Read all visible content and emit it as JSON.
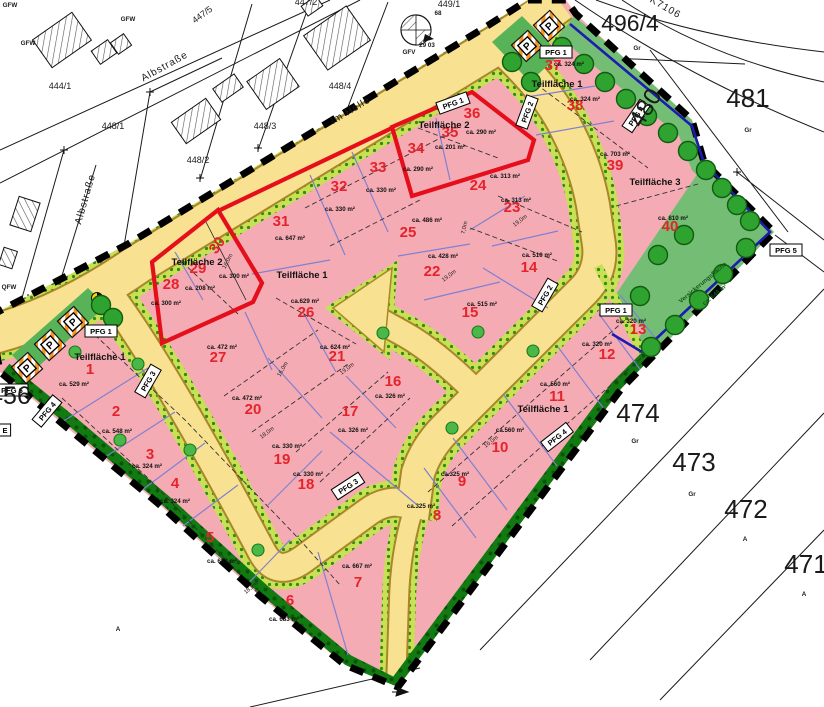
{
  "map": {
    "colors": {
      "plot_pink": "#f5abb4",
      "road_yellow": "#f8e190",
      "road_edge": "#a8872a",
      "veg_strip": "#c8e052",
      "veg_dot": "#2f8b1f",
      "tree_green": "#2fa32f",
      "zone_green": "#74bd74",
      "dark_strip": "#117a11",
      "boundary_black": "#000000",
      "red_outline": "#e50e1b",
      "blue_line": "#1c1cb0",
      "parcel_blue": "#8080d0",
      "plot_number_red": "#e5232b"
    },
    "plots": [
      {
        "no": "1",
        "num_xy": [
          90,
          374
        ],
        "area": "ca. 529 m²",
        "area_xy": [
          74,
          386
        ]
      },
      {
        "no": "2",
        "num_xy": [
          116,
          416
        ],
        "area": "ca. 548 m²",
        "area_xy": [
          117,
          433
        ]
      },
      {
        "no": "3",
        "num_xy": [
          150,
          459
        ],
        "area": "ca. 324 m²",
        "area_xy": [
          147,
          468
        ]
      },
      {
        "no": "4",
        "num_xy": [
          175,
          488
        ],
        "area": "ca. 324 m²",
        "area_xy": [
          175,
          503
        ]
      },
      {
        "no": "5",
        "num_xy": [
          210,
          542
        ],
        "area": "ca. 623 m²",
        "area_xy": [
          222,
          563
        ]
      },
      {
        "no": "6",
        "num_xy": [
          290,
          605
        ],
        "area": "ca. 683 m²",
        "area_xy": [
          284,
          621
        ]
      },
      {
        "no": "7",
        "num_xy": [
          358,
          587
        ],
        "area": "ca. 667 m²",
        "area_xy": [
          357,
          568
        ]
      },
      {
        "no": "8",
        "num_xy": [
          437,
          520
        ],
        "area": "ca.325 m²",
        "area_xy": [
          421,
          508
        ]
      },
      {
        "no": "9",
        "num_xy": [
          462,
          486
        ],
        "area": "ca.325 m²",
        "area_xy": [
          455,
          476
        ]
      },
      {
        "no": "10",
        "num_xy": [
          500,
          452
        ],
        "area": "ca.560 m²",
        "area_xy": [
          510,
          432
        ]
      },
      {
        "no": "11",
        "num_xy": [
          557,
          401
        ],
        "area": "ca. 560 m²",
        "area_xy": [
          555,
          386
        ]
      },
      {
        "no": "12",
        "num_xy": [
          607,
          359
        ],
        "area": "ca. 320 m²",
        "area_xy": [
          597,
          346
        ]
      },
      {
        "no": "13",
        "num_xy": [
          638,
          334
        ],
        "area": "ca. 320 m²",
        "area_xy": [
          631,
          323
        ]
      },
      {
        "no": "14",
        "num_xy": [
          529,
          272
        ],
        "area": "ca. 510 m²",
        "area_xy": [
          537,
          257
        ]
      },
      {
        "no": "15",
        "num_xy": [
          470,
          317
        ],
        "area": "ca. 515 m²",
        "area_xy": [
          482,
          306
        ]
      },
      {
        "no": "16",
        "num_xy": [
          393,
          386
        ],
        "area": "ca. 326 m²",
        "area_xy": [
          390,
          398
        ]
      },
      {
        "no": "17",
        "num_xy": [
          350,
          416
        ],
        "area": "ca. 326 m²",
        "area_xy": [
          353,
          432
        ]
      },
      {
        "no": "18",
        "num_xy": [
          306,
          489
        ],
        "area": "ca. 330 m²",
        "area_xy": [
          308,
          476
        ]
      },
      {
        "no": "19",
        "num_xy": [
          282,
          464
        ],
        "area": "ca. 330 m²",
        "area_xy": [
          287,
          448
        ]
      },
      {
        "no": "20",
        "num_xy": [
          253,
          414
        ],
        "area": "ca. 472 m²",
        "area_xy": [
          247,
          400
        ]
      },
      {
        "no": "21",
        "num_xy": [
          337,
          361
        ],
        "area": "ca. 624 m²",
        "area_xy": [
          335,
          349
        ]
      },
      {
        "no": "22",
        "num_xy": [
          432,
          276
        ],
        "area": "ca. 428 m²",
        "area_xy": [
          443,
          258
        ]
      },
      {
        "no": "23",
        "num_xy": [
          512,
          212
        ],
        "area": "ca. 313 m²",
        "area_xy": [
          516,
          202
        ]
      },
      {
        "no": "24",
        "num_xy": [
          478,
          190
        ],
        "area": "ca. 313 m²",
        "area_xy": [
          505,
          178
        ]
      },
      {
        "no": "25",
        "num_xy": [
          408,
          237
        ],
        "area": "ca. 486 m²",
        "area_xy": [
          427,
          222
        ]
      },
      {
        "no": "26",
        "num_xy": [
          306,
          317
        ],
        "area": "ca.629 m²",
        "area_xy": [
          305,
          303
        ]
      },
      {
        "no": "27",
        "num_xy": [
          218,
          362
        ],
        "area": "ca. 472 m²",
        "area_xy": [
          222,
          349
        ]
      },
      {
        "no": "28",
        "num_xy": [
          171,
          289
        ],
        "area": "ca. 300 m²",
        "area_xy": [
          166,
          305
        ]
      },
      {
        "no": "29",
        "num_xy": [
          198,
          273
        ],
        "area": "ca. 208 m²",
        "area_xy": [
          200,
          290
        ],
        "area2": "ca. 300 m²",
        "area2_xy": [
          234,
          278
        ]
      },
      {
        "no": "30",
        "num_xy": [
          221,
          248
        ],
        "rot": -55
      },
      {
        "no": "31",
        "num_xy": [
          281,
          226
        ],
        "area": "ca. 647 m²",
        "area_xy": [
          290,
          240
        ]
      },
      {
        "no": "32",
        "num_xy": [
          339,
          191
        ],
        "area": "ca. 330 m²",
        "area_xy": [
          340,
          211
        ]
      },
      {
        "no": "33",
        "num_xy": [
          378,
          172
        ],
        "area": "ca. 330 m²",
        "area_xy": [
          381,
          192
        ]
      },
      {
        "no": "34",
        "num_xy": [
          416,
          153
        ],
        "area": "ca. 290 m²",
        "area_xy": [
          418,
          171
        ]
      },
      {
        "no": "35",
        "num_xy": [
          450,
          137
        ],
        "area": "ca. 201 m²",
        "area_xy": [
          450,
          149
        ]
      },
      {
        "no": "36",
        "num_xy": [
          472,
          118
        ],
        "area": "ca. 290 m²",
        "area_xy": [
          481,
          134
        ]
      },
      {
        "no": "37",
        "num_xy": [
          553,
          70
        ],
        "area": "ca. 324 m²",
        "area_xy": [
          569,
          66
        ]
      },
      {
        "no": "38",
        "num_xy": [
          575,
          110
        ],
        "area": "ca. 324 m²",
        "area_xy": [
          585,
          101
        ]
      },
      {
        "no": "39",
        "num_xy": [
          615,
          170
        ],
        "area": "ca. 703 m²",
        "area_xy": [
          615,
          156
        ]
      },
      {
        "no": "40",
        "num_xy": [
          670,
          231
        ],
        "area": "ca. 810 m²",
        "area_xy": [
          673,
          220
        ]
      }
    ],
    "teilflaechen": [
      {
        "text": "Teilfläche 1",
        "xy": [
          100,
          360
        ]
      },
      {
        "text": "Teilfläche 1",
        "xy": [
          302,
          278
        ]
      },
      {
        "text": "Teilfläche 1",
        "xy": [
          543,
          412
        ]
      },
      {
        "text": "Teilfläche 1",
        "xy": [
          557,
          87
        ]
      },
      {
        "text": "Teilfläche 2",
        "xy": [
          197,
          265
        ]
      },
      {
        "text": "Teilfläche 2",
        "xy": [
          444,
          128
        ]
      },
      {
        "text": "Teilfläche 3",
        "xy": [
          655,
          185
        ]
      }
    ],
    "cadastral_large": [
      {
        "text": "496/4",
        "xy": [
          630,
          31
        ],
        "size": 23
      },
      {
        "text": "481",
        "xy": [
          748,
          107
        ],
        "size": 26
      },
      {
        "text": "480",
        "xy": [
          652,
          112
        ],
        "size": 24,
        "rot": -58
      },
      {
        "text": "474",
        "xy": [
          638,
          422
        ],
        "size": 26
      },
      {
        "text": "473",
        "xy": [
          694,
          471
        ],
        "size": 26
      },
      {
        "text": "472",
        "xy": [
          746,
          518
        ],
        "size": 26
      },
      {
        "text": "471",
        "xy": [
          806,
          573
        ],
        "size": 26
      },
      {
        "text": "456",
        "xy": [
          10,
          404
        ],
        "size": 25
      }
    ],
    "cadastral_small": [
      {
        "text": "444/1",
        "xy": [
          60,
          89
        ]
      },
      {
        "text": "448/1",
        "xy": [
          113,
          129
        ]
      },
      {
        "text": "448/2",
        "xy": [
          198,
          163
        ]
      },
      {
        "text": "448/3",
        "xy": [
          265,
          129
        ]
      },
      {
        "text": "448/4",
        "xy": [
          340,
          89
        ]
      },
      {
        "text": "447/5",
        "xy": [
          204,
          17
        ],
        "rot": -36
      },
      {
        "text": "447/2",
        "xy": [
          306,
          5
        ]
      },
      {
        "text": "449/1",
        "xy": [
          449,
          7
        ]
      }
    ],
    "streets": [
      {
        "text": "Albstraße",
        "xy": [
          166,
          69
        ],
        "rot": -29
      },
      {
        "text": "Albstraße",
        "xy": [
          88,
          200
        ],
        "rot": -74
      },
      {
        "text": "Im Helle",
        "xy": [
          352,
          113
        ],
        "rot": -31
      },
      {
        "text": "K7106",
        "xy": [
          664,
          10
        ],
        "rot": 30,
        "size": 7
      }
    ],
    "tiny_labels": [
      {
        "text": "GFW",
        "xy": [
          10,
          7
        ]
      },
      {
        "text": "GFW",
        "xy": [
          128,
          21
        ]
      },
      {
        "text": "GFW",
        "xy": [
          28,
          45
        ]
      },
      {
        "text": "QFW",
        "xy": [
          9,
          289
        ]
      },
      {
        "text": "GFV",
        "xy": [
          409,
          54
        ]
      },
      {
        "text": "29 03",
        "xy": [
          427,
          47
        ]
      },
      {
        "text": "68",
        "xy": [
          438,
          15
        ]
      },
      {
        "text": "Gr",
        "xy": [
          637,
          50
        ]
      },
      {
        "text": "Gr",
        "xy": [
          748,
          132
        ]
      },
      {
        "text": "Gr",
        "xy": [
          635,
          443
        ]
      },
      {
        "text": "Gr",
        "xy": [
          692,
          496
        ]
      },
      {
        "text": "A",
        "xy": [
          745,
          541
        ]
      },
      {
        "text": "A",
        "xy": [
          804,
          596
        ]
      },
      {
        "text": "A",
        "xy": [
          118,
          631
        ]
      }
    ],
    "dimensions": [
      {
        "text": "16,0m",
        "xy": [
          229,
          262
        ],
        "rot": -62
      },
      {
        "text": "7,0m",
        "xy": [
          466,
          228
        ],
        "rot": -78
      },
      {
        "text": "19,0m",
        "xy": [
          450,
          277
        ],
        "rot": -37
      },
      {
        "text": "19,0m",
        "xy": [
          521,
          222
        ],
        "rot": -37
      },
      {
        "text": "19,0m",
        "xy": [
          348,
          370
        ],
        "rot": -37
      },
      {
        "text": "16,0m",
        "xy": [
          284,
          370
        ],
        "rot": -60
      },
      {
        "text": "18,0m",
        "xy": [
          268,
          434
        ],
        "rot": -37
      },
      {
        "text": "16,0m",
        "xy": [
          492,
          443
        ],
        "rot": -37
      },
      {
        "text": "18,2m",
        "xy": [
          252,
          589
        ],
        "rot": -40
      }
    ],
    "green_labels": [
      {
        "text": "Versickerungsfläche",
        "xy": [
          704,
          284
        ],
        "rot": -40
      },
      {
        "text": "ca. 649 m²",
        "xy": [
          716,
          296
        ],
        "rot": -40
      }
    ],
    "pfg_labels": [
      {
        "text": "PFG 1",
        "xy": [
          453,
          103
        ],
        "rot": -20
      },
      {
        "text": "PFG 1",
        "xy": [
          556,
          52
        ],
        "rot": 0
      },
      {
        "text": "PFG 1",
        "xy": [
          101,
          331
        ],
        "rot": 0
      },
      {
        "text": "PFG 1",
        "xy": [
          616,
          310
        ],
        "rot": 0
      },
      {
        "text": "PFG 2",
        "xy": [
          527,
          112
        ],
        "rot": -70
      },
      {
        "text": "PFG 2",
        "xy": [
          545,
          295
        ],
        "rot": -60
      },
      {
        "text": "PFG 3",
        "xy": [
          148,
          381
        ],
        "rot": -60
      },
      {
        "text": "PFG 3",
        "xy": [
          348,
          486
        ],
        "rot": -33
      },
      {
        "text": "PFG 4",
        "xy": [
          636,
          116
        ],
        "rot": -56
      },
      {
        "text": "PFG 4",
        "xy": [
          557,
          437
        ],
        "rot": -38
      },
      {
        "text": "PFG 4",
        "xy": [
          47,
          411
        ],
        "rot": -50
      },
      {
        "text": "PFG 5",
        "xy": [
          786,
          250
        ],
        "rot": 0
      },
      {
        "text": "PFG 6",
        "xy": [
          12,
          390
        ],
        "rot": 0
      },
      {
        "text": "E",
        "xy": [
          5,
          430
        ],
        "rot": 0
      }
    ],
    "parking_icons": [
      {
        "xy": [
          549,
          26
        ],
        "rot": -42
      },
      {
        "xy": [
          527,
          46
        ],
        "rot": -42
      },
      {
        "xy": [
          73,
          322
        ],
        "rot": -42
      },
      {
        "xy": [
          50,
          345
        ],
        "rot": -42
      },
      {
        "xy": [
          27,
          368
        ],
        "rot": -42
      }
    ],
    "trees_large": [
      {
        "x": 512,
        "y": 62
      },
      {
        "x": 531,
        "y": 82
      },
      {
        "x": 562,
        "y": 47
      },
      {
        "x": 584,
        "y": 64
      },
      {
        "x": 605,
        "y": 82
      },
      {
        "x": 626,
        "y": 99
      },
      {
        "x": 647,
        "y": 116
      },
      {
        "x": 668,
        "y": 133
      },
      {
        "x": 688,
        "y": 151
      },
      {
        "x": 706,
        "y": 170
      },
      {
        "x": 722,
        "y": 188
      },
      {
        "x": 737,
        "y": 205
      },
      {
        "x": 750,
        "y": 221
      },
      {
        "x": 746,
        "y": 248
      },
      {
        "x": 723,
        "y": 274
      },
      {
        "x": 699,
        "y": 300
      },
      {
        "x": 675,
        "y": 325
      },
      {
        "x": 651,
        "y": 347
      },
      {
        "x": 658,
        "y": 255
      },
      {
        "x": 684,
        "y": 235
      },
      {
        "x": 640,
        "y": 296
      },
      {
        "x": 101,
        "y": 305
      },
      {
        "x": 113,
        "y": 318
      }
    ],
    "trees_small": [
      {
        "x": 383,
        "y": 333
      },
      {
        "x": 478,
        "y": 332
      },
      {
        "x": 452,
        "y": 428
      },
      {
        "x": 533,
        "y": 351
      },
      {
        "x": 258,
        "y": 550
      },
      {
        "x": 190,
        "y": 450
      },
      {
        "x": 138,
        "y": 364
      },
      {
        "x": 75,
        "y": 352
      },
      {
        "x": 120,
        "y": 440
      }
    ]
  }
}
